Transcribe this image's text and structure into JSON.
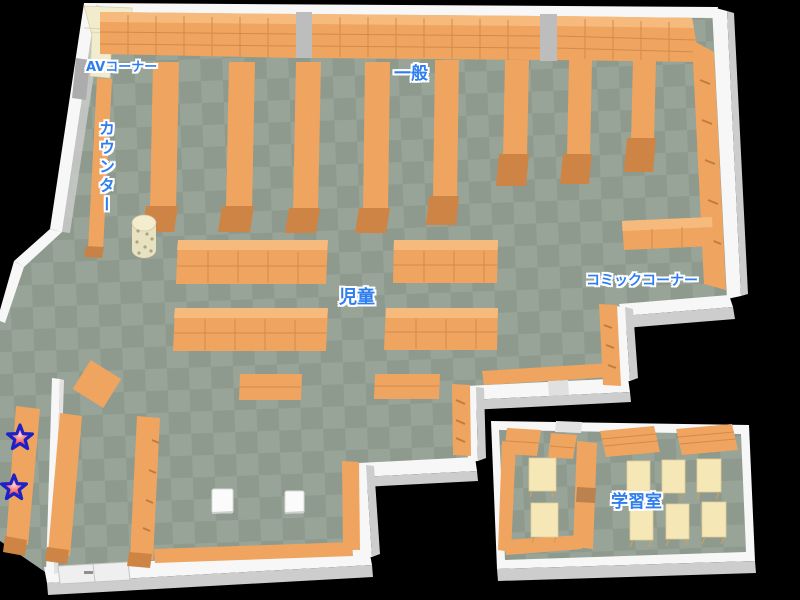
{
  "map": {
    "name": "library-floor-map",
    "labels": {
      "av_corner": "AVコーナー",
      "counter": "カウンター",
      "general": "一般",
      "children": "児童",
      "comic_corner": "コミックコーナー",
      "study_room": "学習室"
    },
    "markers": {
      "star": {
        "glyph": "★",
        "count": 2,
        "fill": "#f25858",
        "outline": "#1c22c8"
      }
    },
    "colors": {
      "background": "#000000",
      "floor_light": "#97a497",
      "floor_dark": "#8d9a8d",
      "wall": "#f7f7f7",
      "wall_shadow": "#cdcdcd",
      "shelf": "#efa55f",
      "shelf_top": "#f6bb7c",
      "shelf_base": "#ce8445",
      "cream_unit": "#f2eccf",
      "table": "#f6e7b7",
      "label_text": "#2e7ef0",
      "label_outline": "#ffffff"
    }
  }
}
